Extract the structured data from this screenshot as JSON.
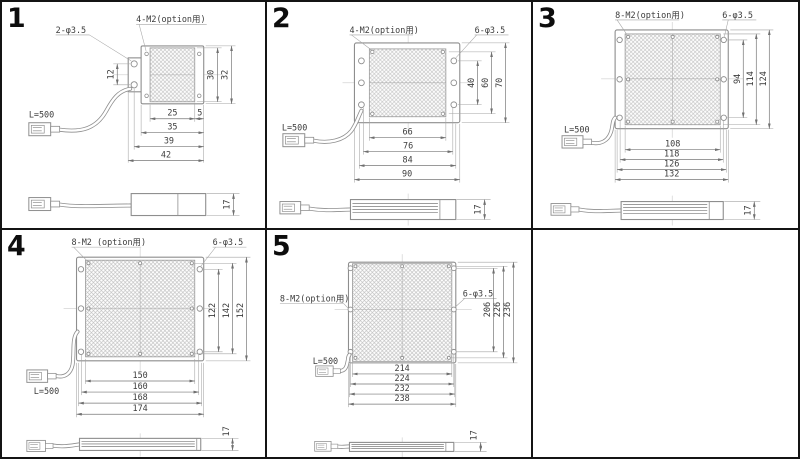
{
  "sheet": {
    "background": "#ffffff",
    "frame_color": "#141414",
    "line_color": "#8e8e8e",
    "text_color": "#3c3c3c"
  },
  "panels": [
    {
      "number": "1",
      "phi_label": "2-φ3.5",
      "m2_label": "4-M2(option用)",
      "cable_label": "L=500",
      "side_height": "17",
      "dims_h": [
        "25",
        "5",
        "35",
        "39",
        "42"
      ],
      "dims_v": [
        "12",
        "30",
        "32"
      ]
    },
    {
      "number": "2",
      "phi_label": "6-φ3.5",
      "m2_label": "4-M2(option用)",
      "cable_label": "L=500",
      "side_height": "17",
      "dims_h": [
        "66",
        "76",
        "84",
        "90"
      ],
      "dims_v": [
        "40",
        "60",
        "70"
      ]
    },
    {
      "number": "3",
      "phi_label": "6-φ3.5",
      "m2_label": "8-M2(option用)",
      "cable_label": "L=500",
      "side_height": "17",
      "dims_h": [
        "108",
        "118",
        "126",
        "132"
      ],
      "dims_v": [
        "94",
        "114",
        "124"
      ]
    },
    {
      "number": "4",
      "phi_label": "6-φ3.5",
      "m2_label": "8-M2 (option用)",
      "cable_label": "L=500",
      "side_height": "17",
      "dims_h": [
        "150",
        "160",
        "168",
        "174"
      ],
      "dims_v": [
        "122",
        "142",
        "152"
      ]
    },
    {
      "number": "5",
      "phi_label": "6-φ3.5",
      "m2_label": "8-M2(option用)",
      "cable_label": "L=500",
      "side_height": "17",
      "dims_h": [
        "214",
        "224",
        "232",
        "238"
      ],
      "dims_v": [
        "206",
        "226",
        "236"
      ]
    }
  ]
}
